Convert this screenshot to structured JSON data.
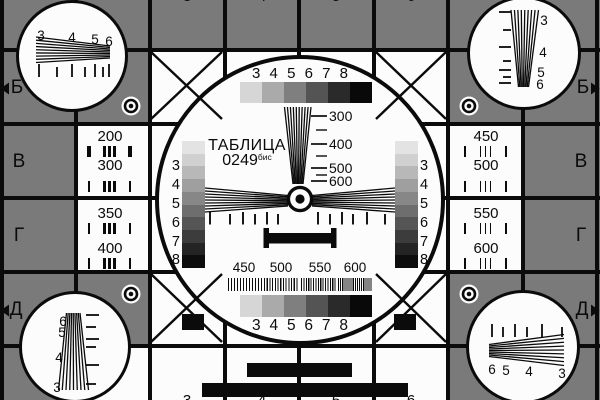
{
  "palette": {
    "bg_gray": "#7a7a7a",
    "cell_white": "#fcfcfc",
    "line_black": "#0b0b0b"
  },
  "card": {
    "title": "ТАБЛИЦА",
    "code": "0249",
    "code_suffix": "бис"
  },
  "edge_letters": {
    "left": [
      "Б",
      "В",
      "Г",
      "Д"
    ],
    "right": [
      "Б",
      "В",
      "Г",
      "Д"
    ]
  },
  "edge_digits_top": [
    "3",
    "4",
    "5",
    "6"
  ],
  "edge_digits_bottom": [
    "3",
    "4",
    "5",
    "6"
  ],
  "grayscale": {
    "digits": [
      "3",
      "4",
      "5",
      "6",
      "7",
      "8"
    ],
    "steps": [
      "#d6d6d6",
      "#aaaaaa",
      "#7f7f7f",
      "#545454",
      "#2a2a2a",
      "#090909"
    ]
  },
  "staircase": {
    "digits": [
      "3",
      "4",
      "5",
      "6",
      "7",
      "8"
    ],
    "steps": [
      "#e3e3e3",
      "#d0d0d0",
      "#b8b8b8",
      "#9f9f9f",
      "#878787",
      "#6e6e6e",
      "#555555",
      "#3c3c3c",
      "#242424",
      "#0d0d0d"
    ]
  },
  "freq_wedge_labels": [
    "300",
    "400",
    "500",
    "600"
  ],
  "burst_labels": [
    "450",
    "500",
    "550",
    "600"
  ],
  "left_panel_labels": [
    "200",
    "300",
    "350",
    "400"
  ],
  "right_panel_labels": [
    "450",
    "500",
    "550",
    "600"
  ],
  "corner_digits": {
    "top_left": [
      "3",
      "4",
      "5",
      "6"
    ],
    "top_right": [
      "3",
      "4",
      "5",
      "6"
    ],
    "bottom_left": [
      "6",
      "5",
      "4",
      "3"
    ],
    "bottom_right": [
      "6",
      "5",
      "4",
      "3"
    ]
  }
}
